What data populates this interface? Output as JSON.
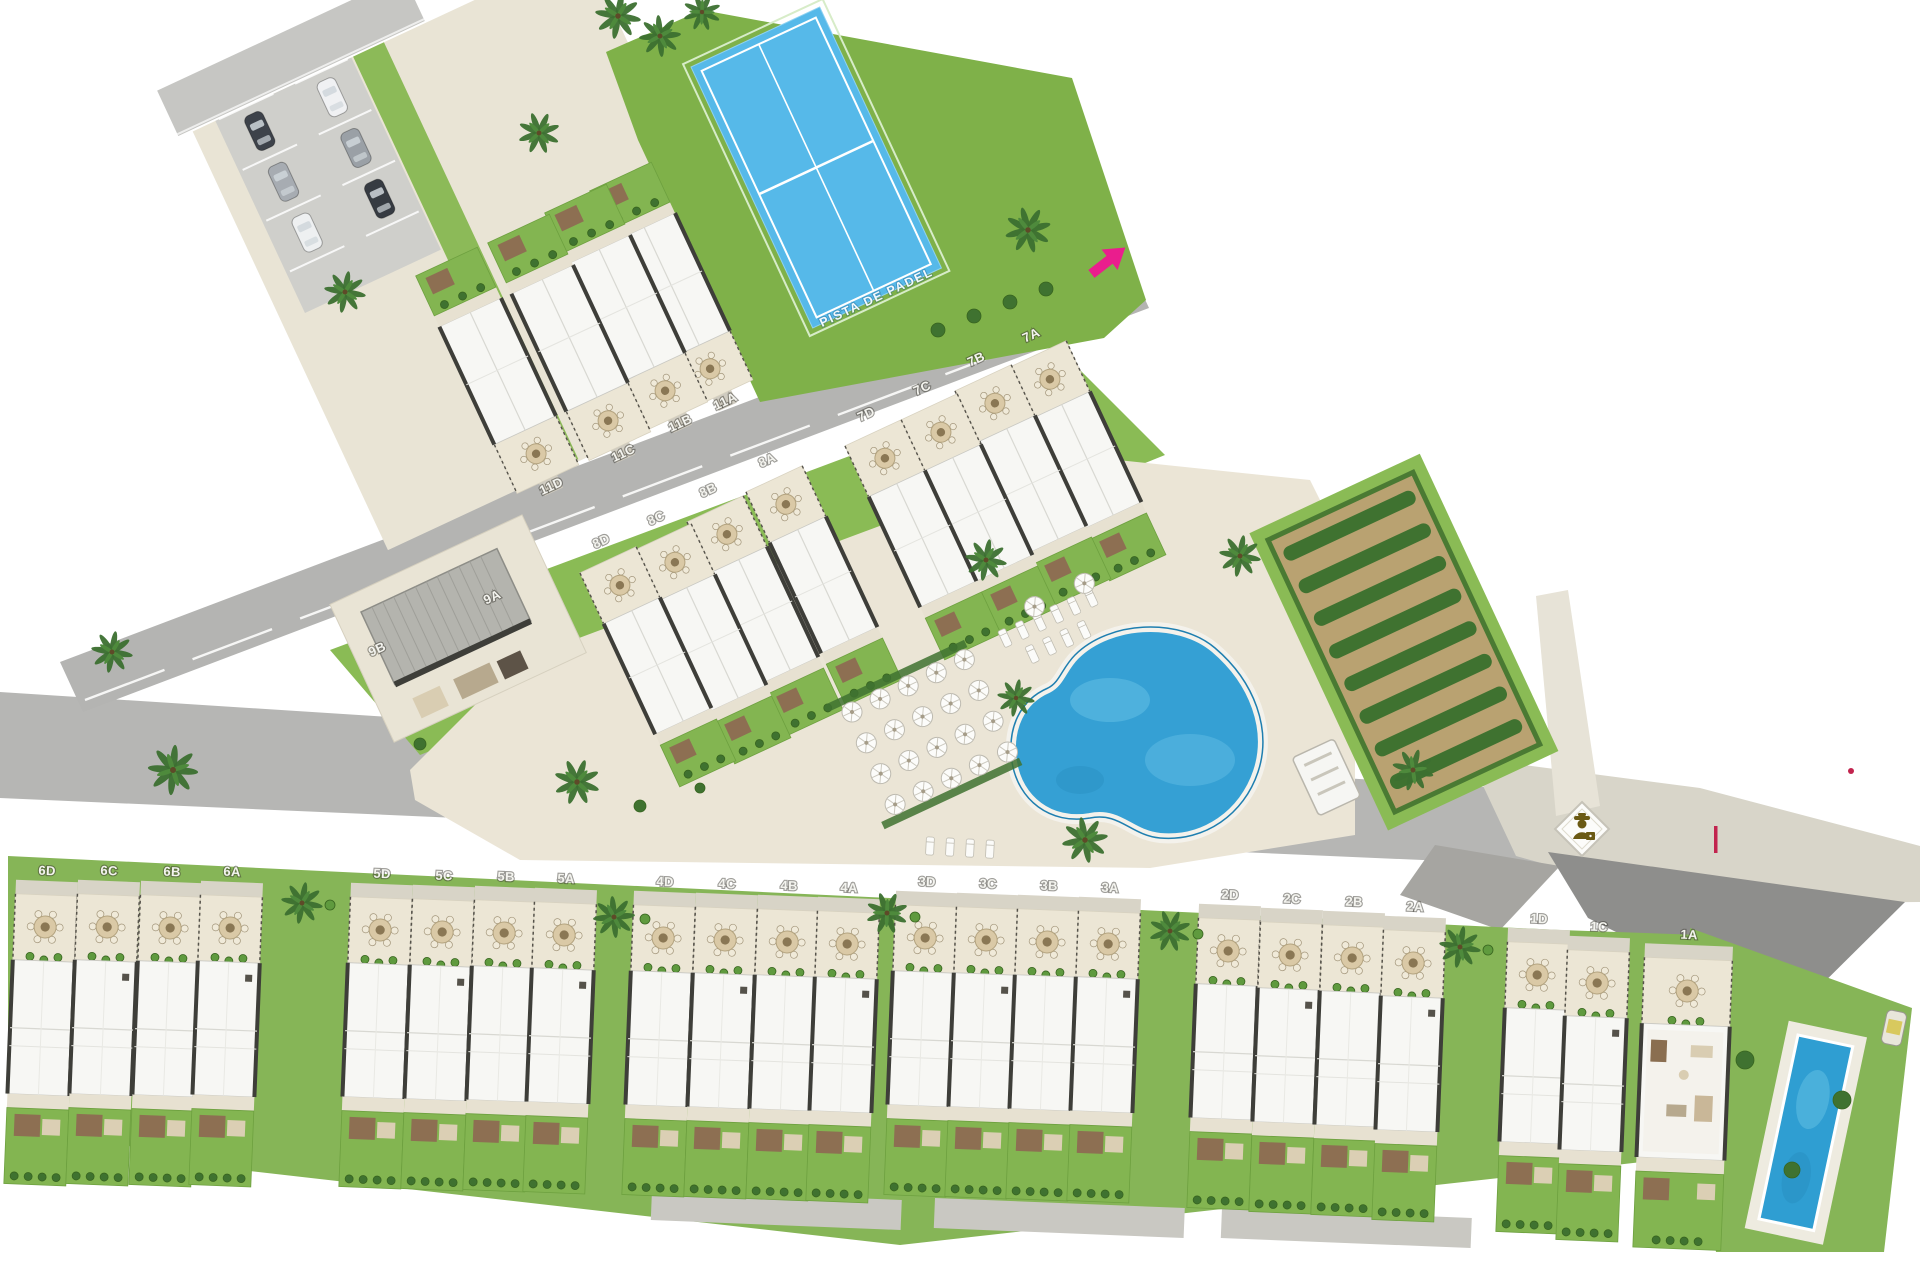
{
  "plan": {
    "title": "residential-site-plan",
    "padel": {
      "label": "PISTA DE PADEL",
      "x": 878,
      "y": 301,
      "rot": -25
    },
    "colors": {
      "background": "#ffffff",
      "road": "#b6b6b4",
      "road_dark": "#8e8e8c",
      "paving": "#e9e4d5",
      "roof": "#f7f7f4",
      "wall_dark": "#3e3e39",
      "grass": "#85b755",
      "hedge_dark": "#3f7230",
      "padel_blue": "#56b9e9",
      "pool_blue": "#35a0d4",
      "soil": "#b9a271",
      "entrance_pink": "#ea1d8d",
      "guard_gold": "#6b5a14",
      "marker_red": "#c2244e"
    },
    "icons": {
      "entrance_arrow": "entrance-arrow-icon",
      "security_guard": "security-guard-icon",
      "palm_tree": "palm-tree-icon",
      "parasol": "parasol-icon",
      "terrace_table": "terrace-table-icon"
    },
    "unit_labels": [
      {
        "id": "11A",
        "x": 727,
        "y": 405,
        "rot": -25,
        "band": "diag-up"
      },
      {
        "id": "11B",
        "x": 682,
        "y": 427,
        "rot": -25,
        "band": "diag-up"
      },
      {
        "id": "11C",
        "x": 625,
        "y": 457,
        "rot": -25,
        "band": "diag-up"
      },
      {
        "id": "11D",
        "x": 553,
        "y": 490,
        "rot": -25,
        "band": "diag-up"
      },
      {
        "id": "7A",
        "x": 1033,
        "y": 339,
        "rot": -25,
        "band": "diag"
      },
      {
        "id": "7B",
        "x": 978,
        "y": 363,
        "rot": -25,
        "band": "diag"
      },
      {
        "id": "7C",
        "x": 924,
        "y": 392,
        "rot": -25,
        "band": "diag"
      },
      {
        "id": "7D",
        "x": 868,
        "y": 418,
        "rot": -25,
        "band": "diag"
      },
      {
        "id": "8A",
        "x": 769,
        "y": 464,
        "rot": -25,
        "band": "diag"
      },
      {
        "id": "8B",
        "x": 710,
        "y": 494,
        "rot": -25,
        "band": "diag"
      },
      {
        "id": "8C",
        "x": 658,
        "y": 522,
        "rot": -25,
        "band": "diag"
      },
      {
        "id": "8D",
        "x": 603,
        "y": 545,
        "rot": -25,
        "band": "diag"
      },
      {
        "id": "9A",
        "x": 494,
        "y": 601,
        "rot": -25,
        "band": "label-only"
      },
      {
        "id": "9B",
        "x": 379,
        "y": 653,
        "rot": -25,
        "band": "label-only"
      },
      {
        "id": "6D",
        "x": 47,
        "y": 875,
        "rot": 2.3,
        "band": "bottom"
      },
      {
        "id": "6C",
        "x": 109,
        "y": 875,
        "rot": 2.3,
        "band": "bottom"
      },
      {
        "id": "6B",
        "x": 172,
        "y": 876,
        "rot": 2.3,
        "band": "bottom"
      },
      {
        "id": "6A",
        "x": 232,
        "y": 876,
        "rot": 2.3,
        "band": "bottom"
      },
      {
        "id": "5D",
        "x": 382,
        "y": 878,
        "rot": 2.3,
        "band": "bottom"
      },
      {
        "id": "5C",
        "x": 444,
        "y": 880,
        "rot": 2.3,
        "band": "bottom"
      },
      {
        "id": "5B",
        "x": 506,
        "y": 881,
        "rot": 2.3,
        "band": "bottom"
      },
      {
        "id": "5A",
        "x": 566,
        "y": 883,
        "rot": 2.3,
        "band": "bottom"
      },
      {
        "id": "4D",
        "x": 665,
        "y": 886,
        "rot": 2.3,
        "band": "bottom"
      },
      {
        "id": "4C",
        "x": 727,
        "y": 888,
        "rot": 2.3,
        "band": "bottom"
      },
      {
        "id": "4B",
        "x": 789,
        "y": 890,
        "rot": 2.3,
        "band": "bottom"
      },
      {
        "id": "4A",
        "x": 849,
        "y": 892,
        "rot": 2.3,
        "band": "bottom"
      },
      {
        "id": "3D",
        "x": 927,
        "y": 886,
        "rot": 2.3,
        "band": "bottom"
      },
      {
        "id": "3C",
        "x": 988,
        "y": 888,
        "rot": 2.3,
        "band": "bottom"
      },
      {
        "id": "3B",
        "x": 1049,
        "y": 890,
        "rot": 2.3,
        "band": "bottom"
      },
      {
        "id": "3A",
        "x": 1110,
        "y": 892,
        "rot": 2.3,
        "band": "bottom"
      },
      {
        "id": "2D",
        "x": 1230,
        "y": 899,
        "rot": 2.3,
        "band": "bottom"
      },
      {
        "id": "2C",
        "x": 1292,
        "y": 903,
        "rot": 2.3,
        "band": "bottom"
      },
      {
        "id": "2B",
        "x": 1354,
        "y": 906,
        "rot": 2.3,
        "band": "bottom"
      },
      {
        "id": "2A",
        "x": 1415,
        "y": 911,
        "rot": 2.3,
        "band": "bottom"
      },
      {
        "id": "1D",
        "x": 1539,
        "y": 923,
        "rot": 2.3,
        "band": "bottom"
      },
      {
        "id": "1C",
        "x": 1599,
        "y": 931,
        "rot": 2.3,
        "band": "bottom"
      },
      {
        "id": "1A",
        "x": 1689,
        "y": 939,
        "rot": 2.3,
        "band": "bottom-wide"
      }
    ]
  }
}
